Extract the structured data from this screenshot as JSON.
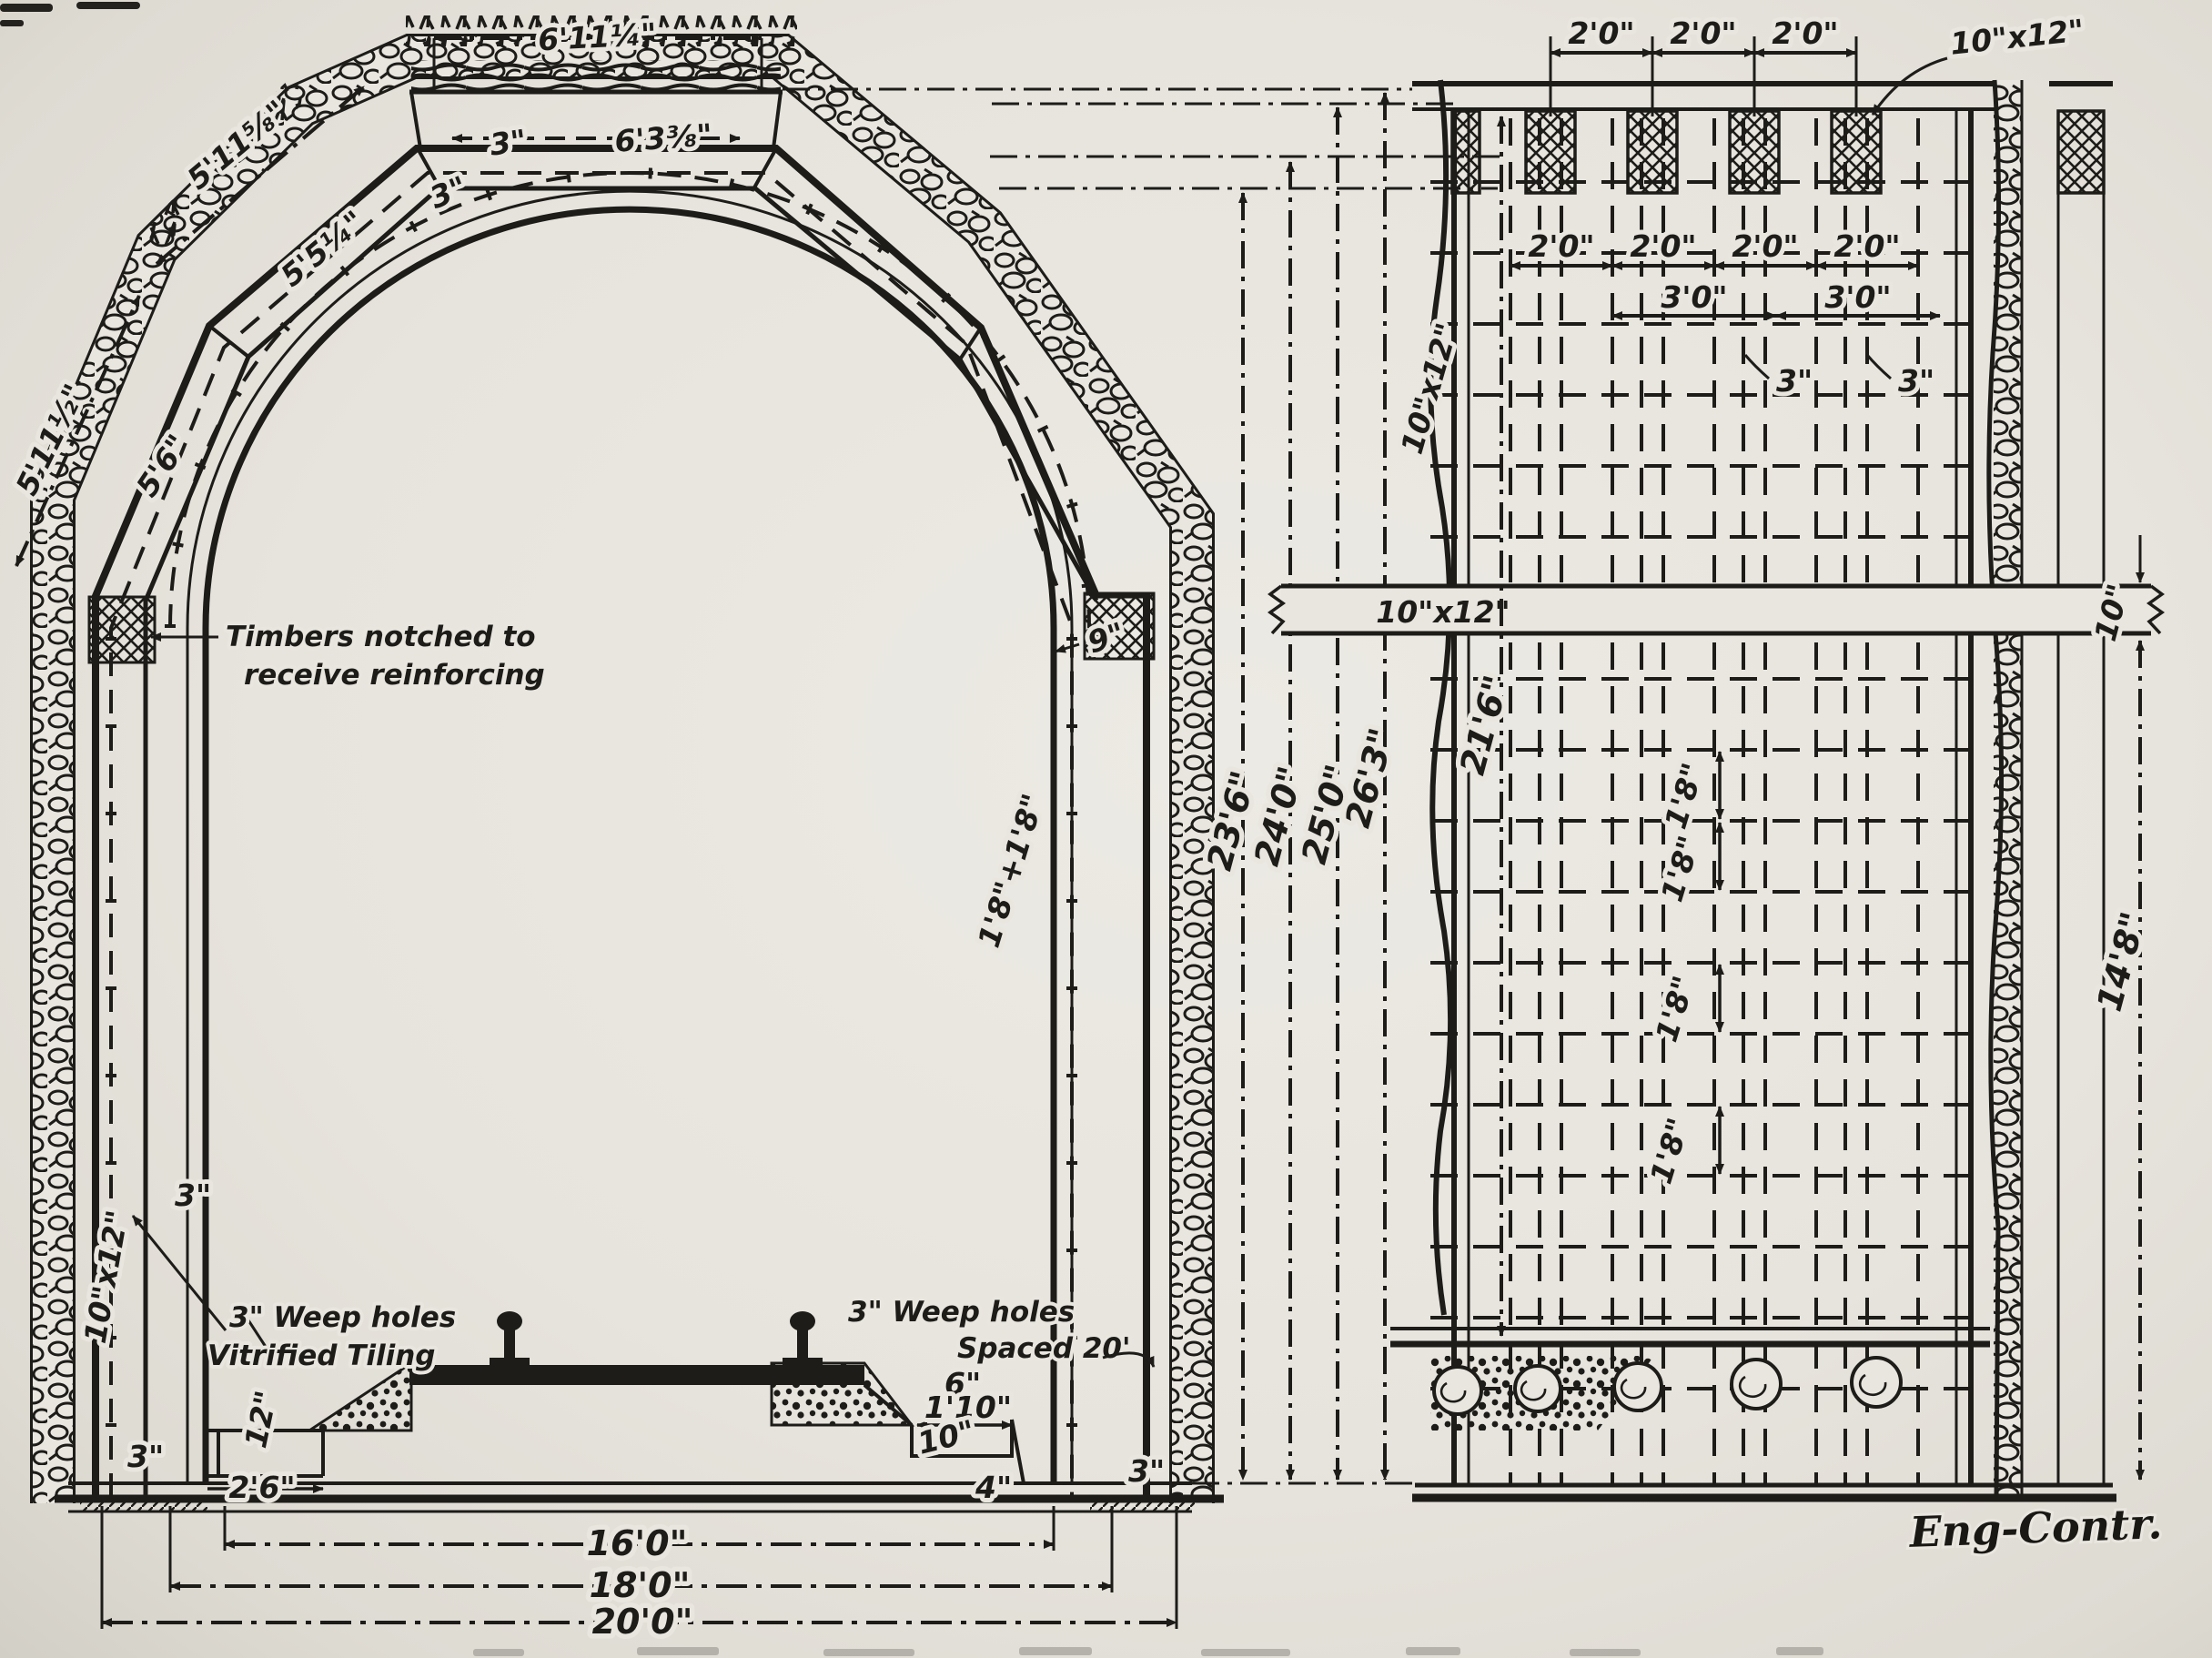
{
  "figure": {
    "credit": "Eng-Contr."
  },
  "cross_section": {
    "notes": {
      "timbers_line1": "Timbers notched to",
      "timbers_line2": "receive reinforcing",
      "weep_left_line1": "3\" Weep holes",
      "weep_left_line2": "Vitrified Tiling",
      "weep_right_line1": "3\" Weep holes",
      "weep_right_line2": "Spaced 20'"
    },
    "dims": {
      "crown_outer": "6'11¼\"",
      "crown_inner": "6'3⅜\"",
      "crown_t1": "3\"",
      "crown_t2": "3\"",
      "seg_upper_left": "5'11⅝\"",
      "arc_upper": "5'5¼\"",
      "arc_lower": "5'6\"",
      "seg_lower_left": "5'11½\"",
      "haunch": "9\"",
      "rise_pair": "1'8\"+1'8\"",
      "wall_lagging": "3\"",
      "wall_post": "10\"x12\"",
      "footing_left": "3\"",
      "drain_depth": "12\"",
      "drain_width": "2'6\"",
      "gutter_rise": "6\"",
      "gutter_width": "1'10\"",
      "gutter_depth": "10\"",
      "gutter_lip": "4\"",
      "footing_right": "3\"",
      "width_16": "16'0\"",
      "width_18": "18'0\"",
      "width_20": "20'0\""
    },
    "heights": [
      "23'6\"",
      "24'0\"",
      "25'0\"",
      "26'3\""
    ]
  },
  "elevation": {
    "cap_post_label": "10\"x12\"",
    "left_post_label": "10\"x12\"",
    "wale_label": "10\"x12\"",
    "wale_depth": "10\"",
    "height_inner": "21'6\"",
    "height_lower": "14'8\"",
    "top_spacing": [
      "2'0\"",
      "2'0\"",
      "2'0\""
    ],
    "row2_spacing": [
      "2'0\"",
      "2'0\"",
      "2'0\"",
      "2'0\""
    ],
    "row3_spacing": [
      "3'0\"",
      "3'0\""
    ],
    "bar_size": [
      "3\"",
      "3\""
    ],
    "bar_spacing": [
      "1'8\"",
      "1'8\"",
      "1'8\"",
      "1'8\""
    ]
  }
}
